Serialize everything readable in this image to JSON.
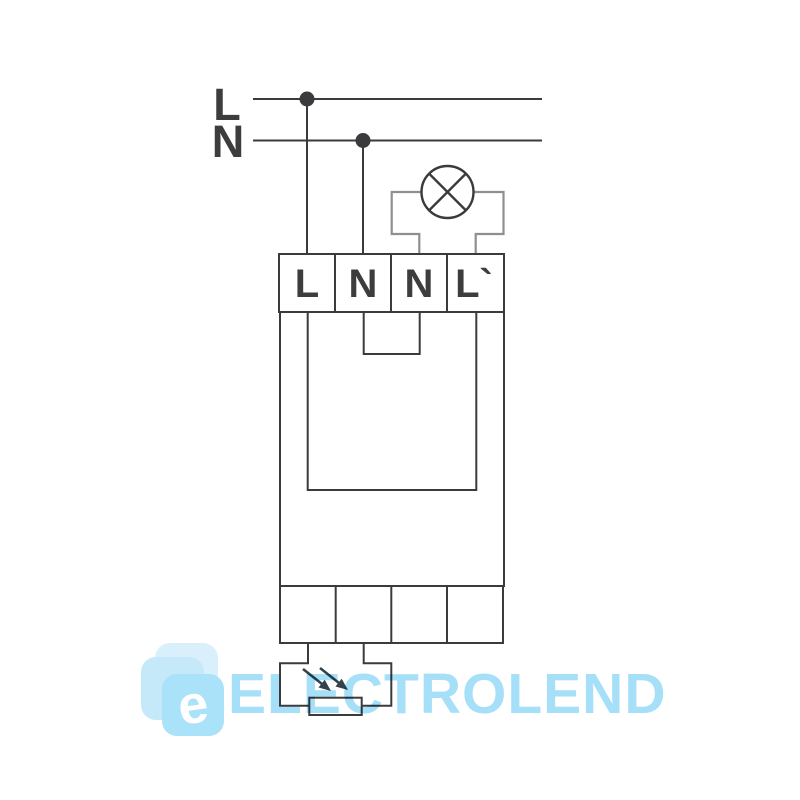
{
  "colors": {
    "ink": "#3b3b3d",
    "grayWire": "#8f8f8f",
    "labelInk": "#3d3d3d",
    "arrowInk": "#36424b",
    "wmBlue": "#a5e0f8",
    "wmLogoFront": "#a9e2f9",
    "wmLogoMid": "#c6e9fa",
    "wmLogoBack": "#d9f0fc",
    "background": "#ffffff"
  },
  "supply": {
    "line_label": "L",
    "neutral_label": "N"
  },
  "terminals": {
    "top": [
      "L",
      "N",
      "N",
      "L`"
    ]
  },
  "watermark": {
    "logo_letter": "e",
    "text": "ELECTROLEND"
  }
}
